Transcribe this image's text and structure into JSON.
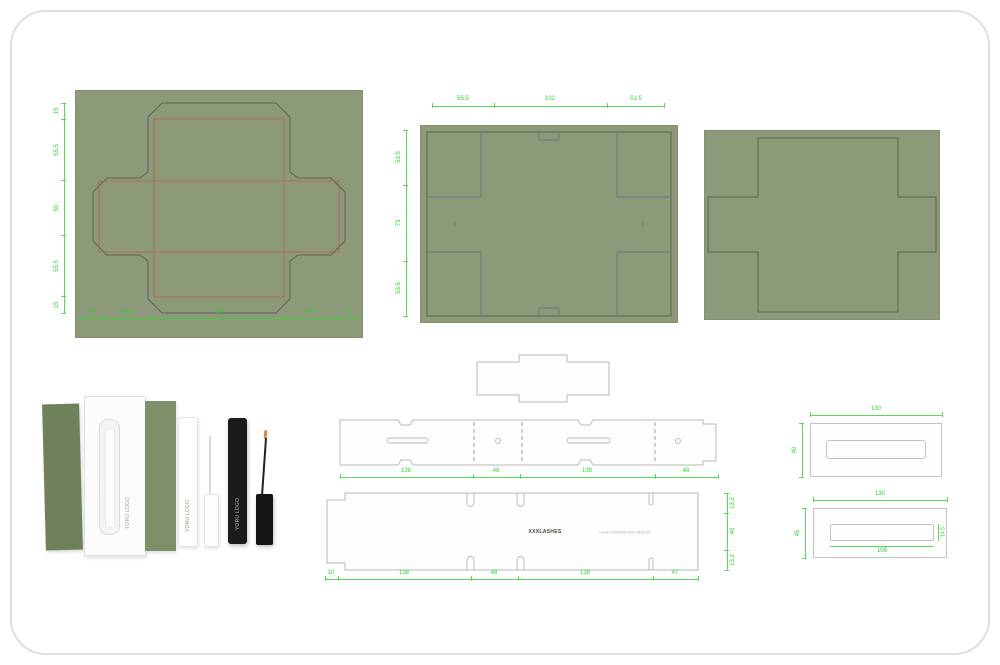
{
  "colors": {
    "panel_green": "#8c9a79",
    "dim_green": "#2fd12f",
    "cut_line": "#5b6351",
    "crease_red": "#b5624f",
    "crease_blue": "#7b85c4",
    "flap_line_blue": "#6b7585",
    "outline_gray": "#b8b8b8",
    "photo_green_dark": "#6e815a",
    "photo_green": "#7d906a",
    "black_tube": "#1b1b1b",
    "brush_tip_orange": "#d98a4f"
  },
  "panel_a": {
    "left_dims": [
      "15",
      "55.5",
      "50",
      "55.5",
      "15"
    ],
    "bottom_dims": [
      "15",
      "38.5",
      "98",
      "38.5",
      "15"
    ]
  },
  "panel_b": {
    "top_dims": [
      "55.5",
      "102",
      "51.5"
    ],
    "left_dims": [
      "53.5",
      "73",
      "53.5"
    ]
  },
  "strip1": {
    "bottom_dims": [
      "138",
      "48",
      "138",
      "48"
    ]
  },
  "strip2": {
    "bottom_dims": [
      "10",
      "138",
      "48",
      "138",
      "47"
    ],
    "right_dims": [
      "13.2",
      "40",
      "13.2"
    ],
    "brand": "XXXLASHES",
    "subtext": "LASH ENHANCING SERUM"
  },
  "tray1": {
    "width": "130",
    "height": "40"
  },
  "tray2": {
    "width": "130",
    "height": "45",
    "window_width": "105",
    "window_height": "14.5"
  },
  "photo": {
    "box_label": "YORU LOGO",
    "white_tube_label": "YORU LOGO",
    "black_tube_label": "YORU LOGO"
  }
}
